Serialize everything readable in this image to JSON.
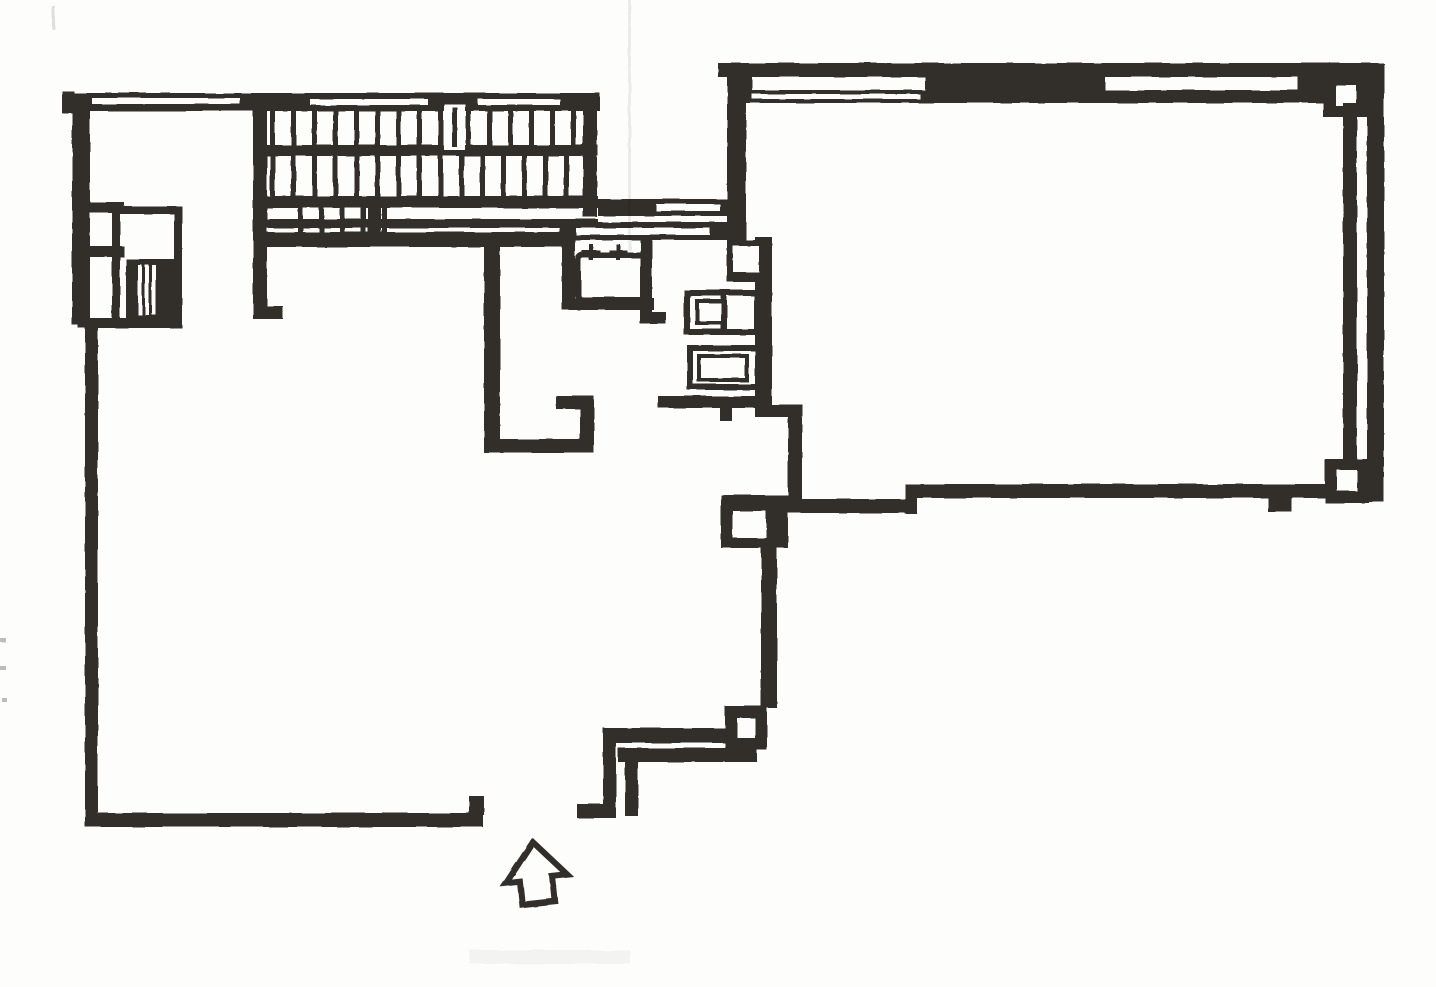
{
  "page": {
    "title": "floor-plan-scan",
    "paper_color": "#fdfdfc",
    "ink_color": "#312e2a",
    "canvas": {
      "width": 1436,
      "height": 987
    }
  },
  "elements": {
    "left_room": "large open room, lower left",
    "right_room": "large open room, upper right, double exterior walls with corner columns",
    "staircase": "double-run switchback stair, top center, with break symbol and under-stair walkway",
    "elevator_shaft": "shaft cluster on left wall with hatched car block",
    "kitchen": "sink with two faucet symbols and two appliance boxes",
    "entrance": "hollow up-arrow at bottom entry gap with vestibule walls"
  },
  "plan": {
    "shapes": [
      {
        "n": "wall-top-cap",
        "t": "r",
        "x": 62,
        "y": 91,
        "w": 12,
        "h": 22
      },
      {
        "n": "wall-top",
        "t": "r",
        "x": 70,
        "y": 93,
        "w": 530,
        "h": 18
      },
      {
        "n": "wall-top-window-slot",
        "t": "w",
        "x": 92,
        "y": 98,
        "w": 148,
        "h": 6
      },
      {
        "n": "wall-top-window-slot",
        "t": "w",
        "x": 310,
        "y": 99,
        "w": 118,
        "h": 6
      },
      {
        "n": "wall-top-window-slot",
        "t": "w",
        "x": 478,
        "y": 99,
        "w": 82,
        "h": 6
      },
      {
        "n": "wall-left-upper",
        "t": "r",
        "x": 72,
        "y": 93,
        "w": 18,
        "h": 232
      },
      {
        "n": "stair-left-wall",
        "t": "r",
        "x": 253,
        "y": 107,
        "w": 14,
        "h": 128
      },
      {
        "n": "stair-right-wall",
        "t": "r",
        "x": 583,
        "y": 107,
        "w": 14,
        "h": 110
      },
      {
        "n": "stair-mid-rail",
        "t": "r",
        "x": 253,
        "y": 145,
        "w": 345,
        "h": 11
      },
      {
        "n": "stair-walkway-top-edge",
        "t": "r",
        "x": 253,
        "y": 196,
        "w": 345,
        "h": 12
      },
      {
        "n": "stair-walkway-bottom-edge",
        "t": "r",
        "x": 253,
        "y": 219,
        "w": 345,
        "h": 9
      },
      {
        "n": "stair-bottom-wall",
        "t": "r",
        "x": 253,
        "y": 232,
        "w": 317,
        "h": 15
      },
      {
        "n": "stair-left-wall-extension",
        "t": "r",
        "x": 253,
        "y": 245,
        "w": 14,
        "h": 68
      },
      {
        "n": "stair-left-wall-foot",
        "t": "r",
        "x": 253,
        "y": 306,
        "w": 30,
        "h": 13
      },
      {
        "n": "stair-walkway-post",
        "t": "r",
        "x": 368,
        "y": 199,
        "w": 13,
        "h": 36
      },
      {
        "n": "stair-treads-upper",
        "t": "treads",
        "xs": [
          270,
          291,
          312,
          333,
          354,
          375,
          396,
          417,
          438,
          466,
          487,
          508,
          529,
          550,
          571
        ],
        "y": 110,
        "w": 5,
        "h": 36
      },
      {
        "n": "stair-break-gap",
        "t": "w",
        "x": 444,
        "y": 104,
        "w": 21,
        "h": 46
      },
      {
        "n": "stair-break-line",
        "t": "r",
        "x": 452,
        "y": 107,
        "w": 5,
        "h": 40
      },
      {
        "n": "stair-treads-lower",
        "t": "treads",
        "xs": [
          270,
          291,
          312,
          333,
          354,
          375,
          396,
          417,
          438,
          459,
          480,
          501,
          522,
          543,
          564
        ],
        "y": 156,
        "w": 5,
        "h": 40
      },
      {
        "n": "stair-treads-short",
        "t": "treads",
        "xs": [
          298,
          319,
          340,
          361,
          382
        ],
        "y": 208,
        "w": 5,
        "h": 24
      },
      {
        "n": "corridor-wall-upper",
        "t": "r",
        "x": 598,
        "y": 199,
        "w": 132,
        "h": 17
      },
      {
        "n": "corridor-wall-upper-slot",
        "t": "w",
        "x": 656,
        "y": 204,
        "w": 64,
        "h": 7
      },
      {
        "n": "corridor-wall-lower",
        "t": "r",
        "x": 560,
        "y": 222,
        "w": 168,
        "h": 18
      },
      {
        "n": "corridor-wall-lower-slot",
        "t": "w",
        "x": 576,
        "y": 228,
        "w": 134,
        "h": 7
      },
      {
        "n": "sink-enclosure-left",
        "t": "r",
        "x": 562,
        "y": 240,
        "w": 13,
        "h": 70
      },
      {
        "n": "sink-enclosure-bottom",
        "t": "r",
        "x": 562,
        "y": 298,
        "w": 92,
        "h": 12
      },
      {
        "n": "sink-enclosure-right",
        "t": "r",
        "x": 640,
        "y": 240,
        "w": 12,
        "h": 84
      },
      {
        "n": "sink-enclosure-foot",
        "t": "r",
        "x": 640,
        "y": 312,
        "w": 26,
        "h": 12
      },
      {
        "n": "sink-basin",
        "t": "o",
        "x": 578,
        "y": 255,
        "w": 68,
        "h": 45,
        "sw": 6,
        "rx": 5
      },
      {
        "n": "faucet-icon",
        "t": "r",
        "x": 582,
        "y": 250,
        "w": 18,
        "h": 4
      },
      {
        "n": "faucet-icon",
        "t": "r",
        "x": 589,
        "y": 244,
        "w": 4,
        "h": 16
      },
      {
        "n": "faucet-icon",
        "t": "r",
        "x": 609,
        "y": 250,
        "w": 18,
        "h": 4
      },
      {
        "n": "faucet-icon",
        "t": "r",
        "x": 616,
        "y": 244,
        "w": 4,
        "h": 16
      },
      {
        "n": "closet-wall-vertical",
        "t": "r",
        "x": 484,
        "y": 237,
        "w": 16,
        "h": 216
      },
      {
        "n": "closet-wall-bottom",
        "t": "r",
        "x": 484,
        "y": 439,
        "w": 98,
        "h": 14
      },
      {
        "n": "closet-stub-horizontal",
        "t": "r",
        "x": 556,
        "y": 396,
        "w": 38,
        "h": 13
      },
      {
        "n": "closet-stub-vertical",
        "t": "r",
        "x": 580,
        "y": 396,
        "w": 14,
        "h": 57
      },
      {
        "n": "shaft-stub-upper",
        "t": "r",
        "x": 74,
        "y": 202,
        "w": 50,
        "h": 11
      },
      {
        "n": "shaft-stub-lower",
        "t": "r",
        "x": 74,
        "y": 246,
        "w": 50,
        "h": 11
      },
      {
        "n": "elevator-shaft-outline",
        "t": "o",
        "x": 116,
        "y": 210,
        "w": 62,
        "h": 114,
        "sw": 8
      },
      {
        "n": "elevator-car-block",
        "t": "r",
        "x": 126,
        "y": 259,
        "w": 50,
        "h": 62
      },
      {
        "n": "elevator-car-slat",
        "t": "w",
        "x": 138,
        "y": 265,
        "w": 4,
        "h": 50
      },
      {
        "n": "elevator-car-slat",
        "t": "w",
        "x": 145,
        "y": 265,
        "w": 4,
        "h": 50
      },
      {
        "n": "elevator-car-slat",
        "t": "w",
        "x": 152,
        "y": 265,
        "w": 4,
        "h": 50
      },
      {
        "n": "elevator-shaft-tie",
        "t": "r",
        "x": 78,
        "y": 318,
        "w": 100,
        "h": 10
      },
      {
        "n": "wall-left-lower",
        "t": "r",
        "x": 85,
        "y": 325,
        "w": 13,
        "h": 502
      },
      {
        "n": "wall-bottom-left",
        "t": "r",
        "x": 88,
        "y": 813,
        "w": 395,
        "h": 14
      },
      {
        "n": "door-jamb-tick",
        "t": "r",
        "x": 469,
        "y": 796,
        "w": 15,
        "h": 19
      },
      {
        "n": "vestibule-outer-wall-vertical",
        "t": "r",
        "x": 603,
        "y": 728,
        "w": 13,
        "h": 90
      },
      {
        "n": "vestibule-outer-wall-horizontal",
        "t": "r",
        "x": 603,
        "y": 728,
        "w": 127,
        "h": 15
      },
      {
        "n": "vestibule-inner-wall-horizontal",
        "t": "r",
        "x": 618,
        "y": 748,
        "w": 139,
        "h": 14
      },
      {
        "n": "vestibule-inner-wall-vertical",
        "t": "r",
        "x": 625,
        "y": 748,
        "w": 13,
        "h": 68
      },
      {
        "n": "vestibule-stub",
        "t": "r",
        "x": 577,
        "y": 804,
        "w": 28,
        "h": 14
      },
      {
        "n": "column-lower",
        "t": "r",
        "x": 725,
        "y": 706,
        "w": 42,
        "h": 44
      },
      {
        "n": "column-lower-core",
        "t": "w",
        "x": 737,
        "y": 718,
        "w": 18,
        "h": 20
      },
      {
        "n": "column-wall",
        "t": "r",
        "x": 761,
        "y": 548,
        "w": 16,
        "h": 160
      },
      {
        "n": "column-upper",
        "t": "r",
        "x": 721,
        "y": 495,
        "w": 67,
        "h": 53
      },
      {
        "n": "column-upper-core",
        "t": "w",
        "x": 733,
        "y": 511,
        "w": 33,
        "h": 27
      },
      {
        "n": "kitchen-wall",
        "t": "r",
        "x": 755,
        "y": 237,
        "w": 17,
        "h": 180
      },
      {
        "n": "kitchen-wall-jog",
        "t": "r",
        "x": 755,
        "y": 405,
        "w": 48,
        "h": 12
      },
      {
        "n": "kitchen-wall-lower",
        "t": "r",
        "x": 788,
        "y": 417,
        "w": 14,
        "h": 84
      },
      {
        "n": "kitchen-stub",
        "t": "r",
        "x": 658,
        "y": 396,
        "w": 100,
        "h": 12
      },
      {
        "n": "kitchen-stub-tick",
        "t": "r",
        "x": 720,
        "y": 406,
        "w": 12,
        "h": 15
      },
      {
        "n": "wall-niche-frame",
        "t": "r",
        "x": 727,
        "y": 240,
        "w": 45,
        "h": 42
      },
      {
        "n": "wall-niche-core",
        "t": "w",
        "x": 733,
        "y": 246,
        "w": 26,
        "h": 26
      },
      {
        "n": "appliance-box-1",
        "t": "o",
        "x": 687,
        "y": 293,
        "w": 70,
        "h": 39,
        "sw": 6
      },
      {
        "n": "appliance-box-1-divider",
        "t": "r",
        "x": 721,
        "y": 296,
        "w": 6,
        "h": 33
      },
      {
        "n": "appliance-box-1-inner",
        "t": "o",
        "x": 697,
        "y": 301,
        "w": 28,
        "h": 22,
        "sw": 4
      },
      {
        "n": "appliance-box-2",
        "t": "o",
        "x": 690,
        "y": 348,
        "w": 68,
        "h": 39,
        "sw": 6
      },
      {
        "n": "appliance-box-2-inner",
        "t": "o",
        "x": 699,
        "y": 356,
        "w": 48,
        "h": 24,
        "sw": 4
      },
      {
        "n": "right-room-top-wall-outer",
        "t": "r",
        "x": 718,
        "y": 63,
        "w": 665,
        "h": 14
      },
      {
        "n": "right-room-top-wall-chunk",
        "t": "r",
        "x": 925,
        "y": 76,
        "w": 180,
        "h": 15
      },
      {
        "n": "right-room-top-wall-inner",
        "t": "r",
        "x": 742,
        "y": 90,
        "w": 598,
        "h": 13
      },
      {
        "n": "right-room-top-wall-slot",
        "t": "w",
        "x": 752,
        "y": 94,
        "w": 168,
        "h": 5
      },
      {
        "n": "right-room-wall-connector",
        "t": "r",
        "x": 738,
        "y": 65,
        "w": 14,
        "h": 38
      },
      {
        "n": "right-room-wall-connector",
        "t": "r",
        "x": 1298,
        "y": 68,
        "w": 26,
        "h": 30
      },
      {
        "n": "column-top-right",
        "t": "r",
        "x": 1323,
        "y": 75,
        "w": 44,
        "h": 42
      },
      {
        "n": "column-top-right-core",
        "t": "w",
        "x": 1336,
        "y": 85,
        "w": 20,
        "h": 21
      },
      {
        "n": "right-room-right-wall-outer",
        "t": "r",
        "x": 1367,
        "y": 63,
        "w": 17,
        "h": 439
      },
      {
        "n": "right-room-right-wall-inner",
        "t": "r",
        "x": 1343,
        "y": 103,
        "w": 14,
        "h": 362
      },
      {
        "n": "column-bottom-right",
        "t": "r",
        "x": 1325,
        "y": 459,
        "w": 44,
        "h": 44
      },
      {
        "n": "column-bottom-right-core",
        "t": "w",
        "x": 1337,
        "y": 470,
        "w": 20,
        "h": 21
      },
      {
        "n": "right-room-bottom-wall-right",
        "t": "r",
        "x": 905,
        "y": 484,
        "w": 424,
        "h": 14
      },
      {
        "n": "right-room-bottom-wall-step",
        "t": "r",
        "x": 905,
        "y": 484,
        "w": 12,
        "h": 30
      },
      {
        "n": "right-room-bottom-wall-left",
        "t": "r",
        "x": 788,
        "y": 499,
        "w": 122,
        "h": 14
      },
      {
        "n": "right-room-bottom-tick",
        "t": "r",
        "x": 1268,
        "y": 497,
        "w": 24,
        "h": 15
      },
      {
        "n": "right-room-left-wall",
        "t": "r",
        "x": 727,
        "y": 73,
        "w": 19,
        "h": 170
      },
      {
        "n": "scan-crease",
        "t": "f",
        "x": 628,
        "y": 0,
        "w": 3,
        "h": 250,
        "op": 0.07
      },
      {
        "n": "scan-dash",
        "t": "f",
        "x": 0,
        "y": 638,
        "w": 6,
        "h": 4,
        "op": 0.25
      },
      {
        "n": "scan-dash",
        "t": "f",
        "x": 0,
        "y": 666,
        "w": 6,
        "h": 4,
        "op": 0.25
      },
      {
        "n": "scan-dash",
        "t": "f",
        "x": 2,
        "y": 698,
        "w": 5,
        "h": 4,
        "op": 0.25
      },
      {
        "n": "scan-dash",
        "t": "f",
        "x": 52,
        "y": 6,
        "w": 3,
        "h": 24,
        "op": 0.12
      },
      {
        "n": "scan-smudge",
        "t": "f",
        "x": 470,
        "y": 950,
        "w": 160,
        "h": 14,
        "op": 0.04
      },
      {
        "n": "entrance-arrow-icon",
        "t": "p",
        "pts": "536,842 505,880 519,880 519,903 552,903 552,878 567,878",
        "sw": 6,
        "rot": "-6 536 872"
      }
    ]
  }
}
